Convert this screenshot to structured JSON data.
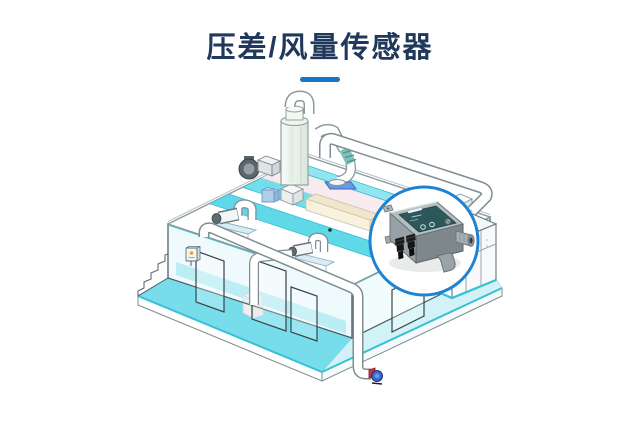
{
  "header": {
    "title": "压差/风量传感器",
    "title_color": "#20395b",
    "divider_color": "#1577c5"
  },
  "illustration": {
    "scene": "isometric-water-treatment-plant",
    "callout_device": "differential-pressure-air-volume-sensor",
    "colors": {
      "callout_ring": "#1e82d2",
      "water_cyan": "#5fd8e8",
      "water_cyan_light": "#c9f1f6",
      "cyan_edge": "#35c0d4",
      "pipe_white": "#ffffff",
      "pipe_outline": "#7e8e93",
      "floor_pink": "#f7ebef",
      "tan_wall": "#efe6cb",
      "pedestal_blue": "#d8ecf4",
      "machine_gray": "#5a666b",
      "sensor_body": "#98a2a6",
      "sensor_top": "#b4bec0",
      "sensor_label_teal": "#2c585c",
      "sensor_fitting_black": "#1a1a1a",
      "drain_pump_blue": "#3a66cc",
      "drain_pump_red": "#cf3333",
      "indicator_orange": "#f0a125",
      "flange_base_blue": "#6a9ae0",
      "coupling_green": "#7fc2ba"
    },
    "parts": [
      "scrubber-tower",
      "blower-unit",
      "left-circulation-pump",
      "center-circulation-pump",
      "roof-duct-pipe",
      "discharge-pipe",
      "drop-pipe",
      "vent-pipe-with-coupling",
      "water-channels",
      "glass-walls",
      "door-openings",
      "stepped-wall",
      "wall-control-box",
      "equipment-cabinet",
      "foundation-slab",
      "drain-pump",
      "sensor-callout"
    ]
  }
}
